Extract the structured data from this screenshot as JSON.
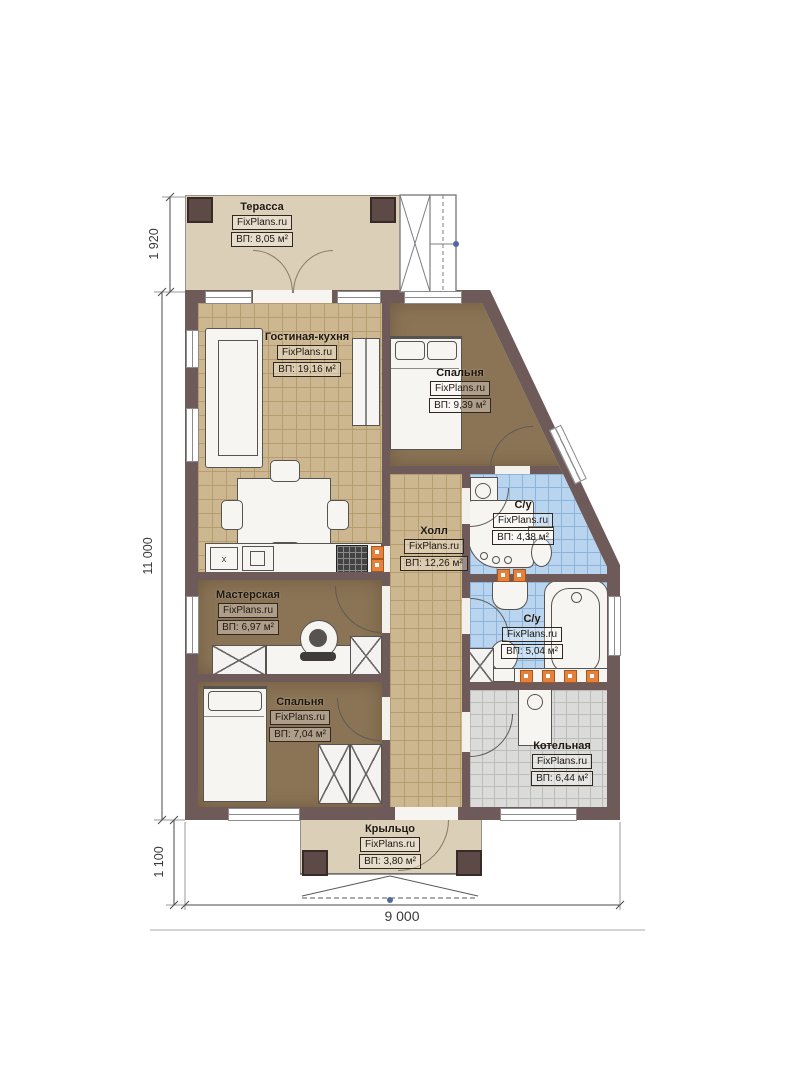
{
  "brand": "FixPlans.ru",
  "rooms": {
    "terrace": {
      "name": "Терасса",
      "brand": "FixPlans.ru",
      "area": "ВП: 8,05 м²"
    },
    "living": {
      "name": "Гостиная-кухня",
      "brand": "FixPlans.ru",
      "area": "ВП: 19,16 м²"
    },
    "bedroom1": {
      "name": "Спальня",
      "brand": "FixPlans.ru",
      "area": "ВП: 9,39 м²"
    },
    "bath1": {
      "name": "С/у",
      "brand": "FixPlans.ru",
      "area": "ВП: 4,38 м²"
    },
    "hall": {
      "name": "Холл",
      "brand": "FixPlans.ru",
      "area": "ВП: 12,26 м²"
    },
    "workshop": {
      "name": "Мастерская",
      "brand": "FixPlans.ru",
      "area": "ВП: 6,97 м²"
    },
    "bath2": {
      "name": "С/у",
      "brand": "FixPlans.ru",
      "area": "ВП: 5,04 м²"
    },
    "bedroom2": {
      "name": "Спальня",
      "brand": "FixPlans.ru",
      "area": "ВП: 7,04 м²"
    },
    "boiler": {
      "name": "Котельная",
      "brand": "FixPlans.ru",
      "area": "ВП: 6,44 м²"
    },
    "porch": {
      "name": "Крыльцо",
      "brand": "FixPlans.ru",
      "area": "ВП: 3,80 м²"
    }
  },
  "dimensions": {
    "terrace_depth": "1 920",
    "house_length": "11 000",
    "porch_depth": "1 100",
    "house_width": "9 000"
  },
  "symbols": {
    "sink_mark": "x"
  },
  "colors": {
    "wall": "#6d5a59",
    "floor_tile": "#cdb791",
    "floor_room": "#8b7456",
    "floor_bath": "#b8d4ef",
    "floor_boiler": "#dbdbd9",
    "deck": "#dccfb8",
    "marker_orange": "#e4813c"
  }
}
